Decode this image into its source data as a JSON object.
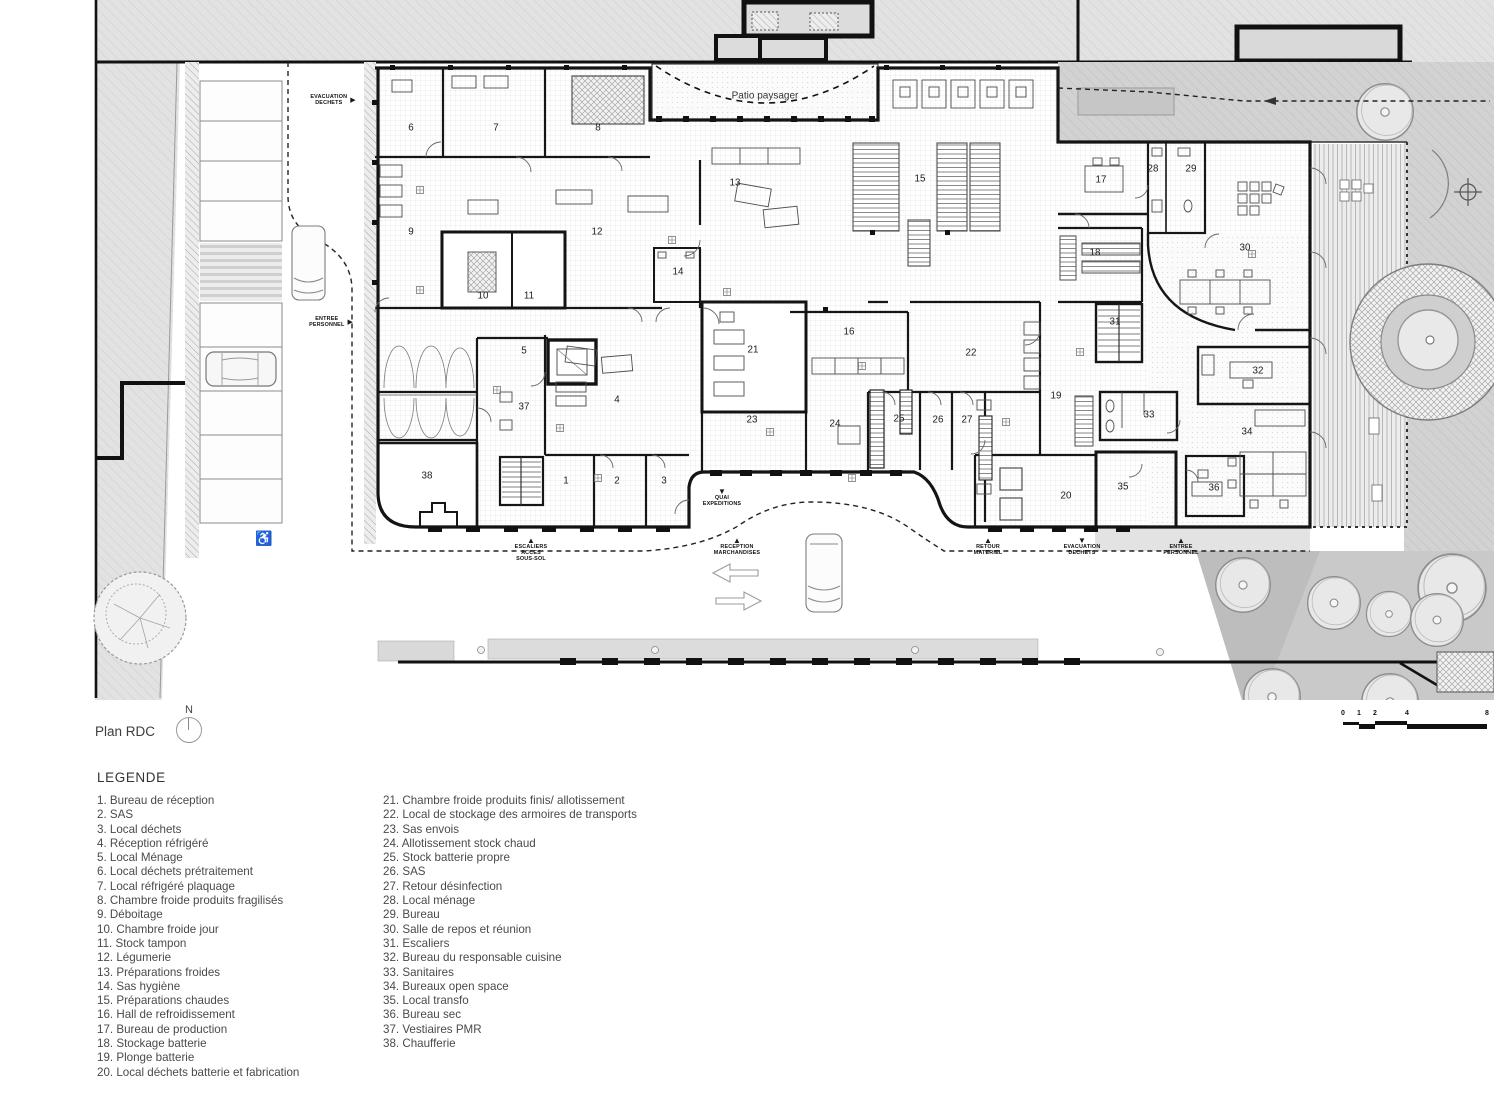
{
  "plan": {
    "title": "Plan RDC",
    "north_label": "N",
    "patio_label": "Patio paysager",
    "rooms": [
      {
        "n": "1",
        "x": 566,
        "y": 481
      },
      {
        "n": "2",
        "x": 617,
        "y": 481
      },
      {
        "n": "3",
        "x": 664,
        "y": 481
      },
      {
        "n": "4",
        "x": 617,
        "y": 400
      },
      {
        "n": "5",
        "x": 524,
        "y": 351
      },
      {
        "n": "6",
        "x": 411,
        "y": 128
      },
      {
        "n": "7",
        "x": 496,
        "y": 128
      },
      {
        "n": "8",
        "x": 598,
        "y": 128
      },
      {
        "n": "9",
        "x": 411,
        "y": 232
      },
      {
        "n": "10",
        "x": 483,
        "y": 296
      },
      {
        "n": "11",
        "x": 529,
        "y": 296
      },
      {
        "n": "12",
        "x": 597,
        "y": 232
      },
      {
        "n": "13",
        "x": 735,
        "y": 183
      },
      {
        "n": "14",
        "x": 678,
        "y": 272
      },
      {
        "n": "15",
        "x": 920,
        "y": 179
      },
      {
        "n": "16",
        "x": 849,
        "y": 332
      },
      {
        "n": "17",
        "x": 1101,
        "y": 180
      },
      {
        "n": "18",
        "x": 1095,
        "y": 253
      },
      {
        "n": "19",
        "x": 1056,
        "y": 396
      },
      {
        "n": "20",
        "x": 1066,
        "y": 496
      },
      {
        "n": "21",
        "x": 753,
        "y": 350
      },
      {
        "n": "22",
        "x": 971,
        "y": 353
      },
      {
        "n": "23",
        "x": 752,
        "y": 420
      },
      {
        "n": "24",
        "x": 835,
        "y": 424
      },
      {
        "n": "25",
        "x": 899,
        "y": 419
      },
      {
        "n": "26",
        "x": 938,
        "y": 420
      },
      {
        "n": "27",
        "x": 967,
        "y": 420
      },
      {
        "n": "28",
        "x": 1153,
        "y": 169
      },
      {
        "n": "29",
        "x": 1191,
        "y": 169
      },
      {
        "n": "30",
        "x": 1245,
        "y": 248
      },
      {
        "n": "31",
        "x": 1115,
        "y": 322
      },
      {
        "n": "32",
        "x": 1258,
        "y": 371
      },
      {
        "n": "33",
        "x": 1149,
        "y": 415
      },
      {
        "n": "34",
        "x": 1247,
        "y": 432
      },
      {
        "n": "35",
        "x": 1123,
        "y": 487
      },
      {
        "n": "36",
        "x": 1214,
        "y": 488
      },
      {
        "n": "37",
        "x": 524,
        "y": 407
      },
      {
        "n": "38",
        "x": 427,
        "y": 476
      }
    ],
    "flow_labels": [
      {
        "lines": [
          "EVACUATION",
          "DECHETS"
        ],
        "x": 333,
        "y": 100,
        "arrow": "right"
      },
      {
        "lines": [
          "ENTREE",
          "PERSONNEL"
        ],
        "x": 331,
        "y": 322,
        "arrow": "right"
      },
      {
        "lines": [
          "QUAI",
          "EXPEDITIONS"
        ],
        "x": 722,
        "y": 488,
        "arrow": "down"
      },
      {
        "lines": [
          "ESCALIERS",
          "ACCES",
          "SOUS-SOL"
        ],
        "x": 531,
        "y": 537,
        "arrow": "up"
      },
      {
        "lines": [
          "RECEPTION",
          "MARCHANDISES"
        ],
        "x": 737,
        "y": 537,
        "arrow": "up"
      },
      {
        "lines": [
          "RETOUR",
          "MATERIEL"
        ],
        "x": 988,
        "y": 537,
        "arrow": "up"
      },
      {
        "lines": [
          "EVACUATION",
          "DECHETS"
        ],
        "x": 1082,
        "y": 537,
        "arrow": "down"
      },
      {
        "lines": [
          "ENTREE",
          "PERSONNEL"
        ],
        "x": 1181,
        "y": 537,
        "arrow": "up"
      }
    ],
    "scale_ticks": [
      {
        "label": "0",
        "x": 13
      },
      {
        "label": "1",
        "x": 29
      },
      {
        "label": "2",
        "x": 45
      },
      {
        "label": "4",
        "x": 77
      },
      {
        "label": "8",
        "x": 157
      }
    ]
  },
  "icons": {
    "wheelchair": "♿",
    "arrow_up": "▲",
    "arrow_down": "▼",
    "arrow_right": "▶"
  },
  "legend": {
    "title": "LEGENDE",
    "column1": [
      "1. Bureau de réception",
      "2. SAS",
      "3. Local déchets",
      "4. Réception réfrigéré",
      "5. Local Ménage",
      "6. Local déchets prétraitement",
      "7. Local réfrigéré plaquage",
      "8. Chambre froide produits fragilisés",
      "9. Déboitage",
      "10. Chambre froide jour",
      "11. Stock tampon",
      "12. Légumerie",
      "13. Préparations froides",
      "14. Sas hygiène",
      "15. Préparations chaudes",
      "16. Hall de refroidissement",
      "17. Bureau de production",
      "18. Stockage batterie",
      "19. Plonge batterie",
      "20. Local déchets batterie et fabrication"
    ],
    "column2": [
      "21. Chambre froide produits finis/ allotissement",
      "22. Local de stockage des armoires de transports",
      "23. Sas envois",
      "24. Allotissement stock chaud",
      "25. Stock batterie propre",
      "26. SAS",
      "27. Retour désinfection",
      "28. Local ménage",
      "29. Bureau",
      "30. Salle de repos et réunion",
      "31. Escaliers",
      "32. Bureau du responsable cuisine",
      "33. Sanitaires",
      "34. Bureaux open space",
      "35. Local transfo",
      "36. Bureau sec",
      "37. Vestiaires PMR",
      "38. Chaufferie"
    ]
  }
}
